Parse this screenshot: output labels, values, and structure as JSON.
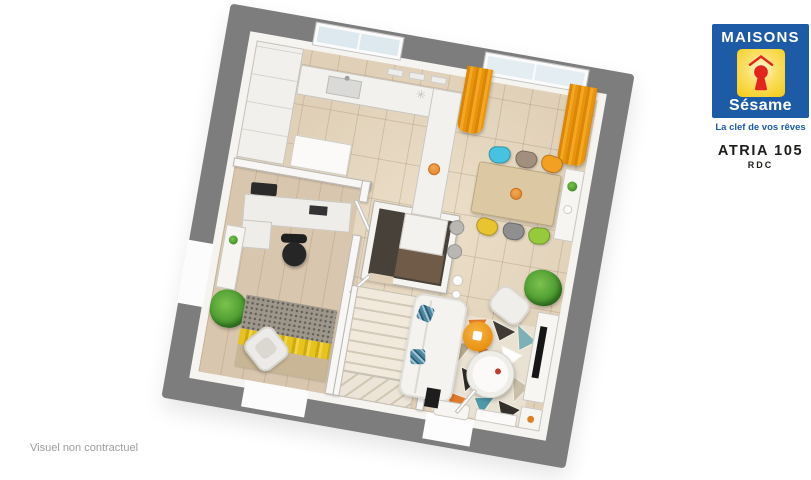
{
  "brand": {
    "line1": "MAISONS",
    "line2": "Sésame",
    "tagline": "La clef de vos rêves",
    "colors": {
      "blue": "#1d5ba7",
      "yellow": "#f5ca0d",
      "red": "#e3251d",
      "white": "#ffffff"
    },
    "icons": {
      "keyhole-icon": "red keyhole inside yellow square",
      "roof-icon": "red house roof outline above keyhole"
    }
  },
  "plan_label": {
    "title": "ATRIA 105",
    "floor": "RDC"
  },
  "footer": {
    "disclaimer": "Visuel non contractuel"
  },
  "floorplan": {
    "view": "3D top-down render of ground floor, rotated ~10°",
    "frame_color": "#7d7d7d",
    "wall_color": "#f6f4f1",
    "floor_tile_color": "#e0d0b8",
    "office_floor_color": "#d9c6ae",
    "curtain_color": "#e8940e",
    "accent_bowl_color": "#df7f22",
    "dining_chair_colors": {
      "top_row": [
        "#45c3e0",
        "#a28f7d",
        "#f2a024"
      ],
      "bottom_row": [
        "#e8c430",
        "#8f8f8f",
        "#97c93d"
      ]
    },
    "living_rug_colors": [
      "#e9e1d2",
      "#e07b2a",
      "#4f9aa8",
      "#2e2a26",
      "#cabfa8",
      "#ffffff"
    ],
    "office_rug_colors": [
      "#9d968a",
      "#e6c41d",
      "#c9b696"
    ]
  }
}
